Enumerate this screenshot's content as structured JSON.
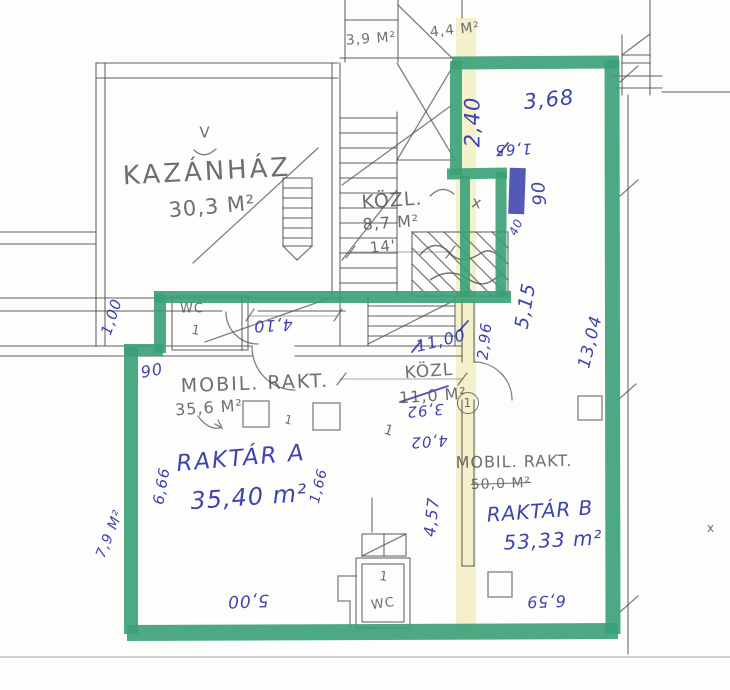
{
  "document": {
    "type": "scanned hand-annotated floor plan",
    "language": "Hungarian"
  },
  "colors": {
    "paper": "#fdfdfb",
    "pencil": "#4f4f4f",
    "ink": "#2e34a8",
    "marker": "#3aa076",
    "highlight": "#f1e9b8"
  },
  "rooms": [
    {
      "name": "KAZÁNHÁZ",
      "area": "30,3 M²"
    },
    {
      "name": "KÖZL.",
      "area": "8,7 M²"
    },
    {
      "name": "MOBIL. RAKT.",
      "area": "35,6 M²"
    },
    {
      "name": "KÖZL",
      "area": "11,0 M²"
    },
    {
      "name": "RAKTÁR A",
      "area": "35,40 m²"
    },
    {
      "name": "MOBIL. RAKT.",
      "area": "50,0 M²"
    },
    {
      "name": "RAKTÁR B",
      "area": "53,33 m²"
    },
    {
      "name": "WC",
      "count": 2
    }
  ],
  "labels": [
    {
      "id": "kazanhaz-name",
      "text": "KAZÁNHÁZ",
      "x": 207,
      "y": 172,
      "rot": -3,
      "c": "pencil",
      "s": 26,
      "sp": 3
    },
    {
      "id": "kazanhaz-area",
      "text": "30,3 M²",
      "x": 212,
      "y": 207,
      "rot": -5,
      "c": "pencil",
      "s": 21
    },
    {
      "id": "vent-v-mark",
      "text": "V",
      "x": 205,
      "y": 133,
      "rot": 0,
      "c": "pencil",
      "s": 15
    },
    {
      "id": "kozl-upper-name",
      "text": "KÖZL.",
      "x": 392,
      "y": 201,
      "rot": -4,
      "c": "pencil",
      "s": 19
    },
    {
      "id": "kozl-upper-area",
      "text": "8,7 M²",
      "x": 391,
      "y": 223,
      "rot": -4,
      "c": "pencil",
      "s": 16
    },
    {
      "id": "dim-14",
      "text": "14'",
      "x": 383,
      "y": 247,
      "rot": -6,
      "c": "pencil",
      "s": 15
    },
    {
      "id": "top-area-1",
      "text": "3,9 M²",
      "x": 371,
      "y": 39,
      "rot": -4,
      "c": "pencil",
      "s": 14
    },
    {
      "id": "top-area-2",
      "text": "4,4 M²",
      "x": 455,
      "y": 30,
      "rot": -6,
      "c": "pencil",
      "s": 14
    },
    {
      "id": "mobil-left-name",
      "text": "MOBIL. RAKT.",
      "x": 255,
      "y": 384,
      "rot": -2,
      "c": "pencil",
      "s": 19,
      "sp": 2
    },
    {
      "id": "mobil-left-area",
      "text": "35,6 M²",
      "x": 209,
      "y": 408,
      "rot": -4,
      "c": "pencil",
      "s": 16
    },
    {
      "id": "kozl-center-name",
      "text": "KÖZL",
      "x": 429,
      "y": 372,
      "rot": -4,
      "c": "pencil",
      "s": 17
    },
    {
      "id": "kozl-center-area",
      "text": "11,0 M²",
      "x": 433,
      "y": 396,
      "rot": -4,
      "c": "pencil",
      "s": 16
    },
    {
      "id": "mobil-right-name",
      "text": "MOBIL. RAKT.",
      "x": 514,
      "y": 462,
      "rot": -1,
      "c": "pencil",
      "s": 16,
      "sp": 1
    },
    {
      "id": "mobil-right-area",
      "text": "50,0 M²",
      "x": 501,
      "y": 484,
      "rot": -2,
      "c": "pencil",
      "s": 14,
      "strike": true
    },
    {
      "id": "wc-upper-label",
      "text": "WC",
      "x": 192,
      "y": 309,
      "rot": 0,
      "c": "pencil",
      "s": 13
    },
    {
      "id": "wc-upper-num",
      "text": "1",
      "x": 196,
      "y": 331,
      "rot": 10,
      "c": "pencil",
      "s": 13
    },
    {
      "id": "wc-lower-num",
      "text": "1",
      "x": 384,
      "y": 577,
      "rot": 8,
      "c": "pencil",
      "s": 13
    },
    {
      "id": "wc-lower-label",
      "text": "WC",
      "x": 383,
      "y": 604,
      "rot": -8,
      "c": "pencil",
      "s": 13
    },
    {
      "id": "x-mark-strip",
      "text": "x",
      "x": 477,
      "y": 203,
      "rot": 12,
      "c": "pencil",
      "s": 16
    },
    {
      "id": "circled-1",
      "text": "1",
      "x": 468,
      "y": 403,
      "rot": 0,
      "c": "pencil",
      "s": 12,
      "circle": true
    },
    {
      "id": "tick-1a",
      "text": "1",
      "x": 389,
      "y": 431,
      "rot": 18,
      "c": "pencil",
      "s": 14
    },
    {
      "id": "tick-1b",
      "text": "1",
      "x": 289,
      "y": 420,
      "rot": 15,
      "c": "pencil",
      "s": 12
    },
    {
      "id": "x-mark-right",
      "text": "x",
      "x": 711,
      "y": 528,
      "rot": 0,
      "c": "pencil",
      "s": 12
    },
    {
      "id": "dim-2-40",
      "text": "2,40",
      "x": 473,
      "y": 122,
      "rot": -90,
      "c": "ink",
      "s": 21
    },
    {
      "id": "dim-3-68",
      "text": "3,68",
      "x": 549,
      "y": 100,
      "rot": -6,
      "c": "ink",
      "s": 21
    },
    {
      "id": "dim-1-65",
      "text": "1,65",
      "x": 513,
      "y": 149,
      "rot": 177,
      "c": "ink",
      "s": 15
    },
    {
      "id": "dim-90-door",
      "text": "90",
      "x": 540,
      "y": 193,
      "rot": -95,
      "c": "ink",
      "s": 18
    },
    {
      "id": "dim-40",
      "text": "40",
      "x": 516,
      "y": 227,
      "rot": -65,
      "c": "ink",
      "s": 12
    },
    {
      "id": "dim-5-15",
      "text": "5,15",
      "x": 526,
      "y": 306,
      "rot": -80,
      "c": "ink",
      "s": 19
    },
    {
      "id": "dim-13-04",
      "text": "13,04",
      "x": 591,
      "y": 342,
      "rot": -76,
      "c": "ink",
      "s": 17
    },
    {
      "id": "dim-2-96",
      "text": "2,96",
      "x": 485,
      "y": 341,
      "rot": -84,
      "c": "ink",
      "s": 15
    },
    {
      "id": "dim-11-00",
      "text": "11,00",
      "x": 441,
      "y": 341,
      "rot": -14,
      "c": "ink",
      "s": 16
    },
    {
      "id": "dim-3-92",
      "text": "3,92",
      "x": 425,
      "y": 410,
      "rot": 175,
      "c": "ink",
      "s": 15
    },
    {
      "id": "dim-4-02",
      "text": "4,02",
      "x": 429,
      "y": 441,
      "rot": 176,
      "c": "ink",
      "s": 15
    },
    {
      "id": "dim-4-10",
      "text": "4,10",
      "x": 273,
      "y": 325,
      "rot": 177,
      "c": "ink",
      "s": 16
    },
    {
      "id": "dim-1-00",
      "text": "1,00",
      "x": 112,
      "y": 317,
      "rot": -72,
      "c": "ink",
      "s": 15
    },
    {
      "id": "dim-90-left",
      "text": "90",
      "x": 152,
      "y": 371,
      "rot": -10,
      "c": "ink",
      "s": 16
    },
    {
      "id": "dim-6-66",
      "text": "6,66",
      "x": 162,
      "y": 486,
      "rot": -80,
      "c": "ink",
      "s": 15
    },
    {
      "id": "area-7-9",
      "text": "7,9 M²",
      "x": 110,
      "y": 534,
      "rot": -68,
      "c": "ink",
      "s": 14
    },
    {
      "id": "dim-1-66",
      "text": "1,66",
      "x": 319,
      "y": 486,
      "rot": -76,
      "c": "ink",
      "s": 14
    },
    {
      "id": "raktar-a-name",
      "text": "RAKTÁR A",
      "x": 241,
      "y": 459,
      "rot": -5,
      "c": "ink",
      "s": 23,
      "sp": 2
    },
    {
      "id": "raktar-a-area",
      "text": "35,40 m²",
      "x": 249,
      "y": 497,
      "rot": -4,
      "c": "ink",
      "s": 24
    },
    {
      "id": "raktar-b-name",
      "text": "RAKTÁR B",
      "x": 540,
      "y": 511,
      "rot": -4,
      "c": "ink",
      "s": 20
    },
    {
      "id": "raktar-b-area",
      "text": "53,33 m²",
      "x": 553,
      "y": 540,
      "rot": -3,
      "c": "ink",
      "s": 20
    },
    {
      "id": "dim-4-57",
      "text": "4,57",
      "x": 432,
      "y": 517,
      "rot": -84,
      "c": "ink",
      "s": 16
    },
    {
      "id": "dim-5-00",
      "text": "5,00",
      "x": 248,
      "y": 600,
      "rot": 178,
      "c": "ink",
      "s": 17
    },
    {
      "id": "dim-6-59",
      "text": "6,59",
      "x": 546,
      "y": 601,
      "rot": 178,
      "c": "ink",
      "s": 16
    }
  ]
}
